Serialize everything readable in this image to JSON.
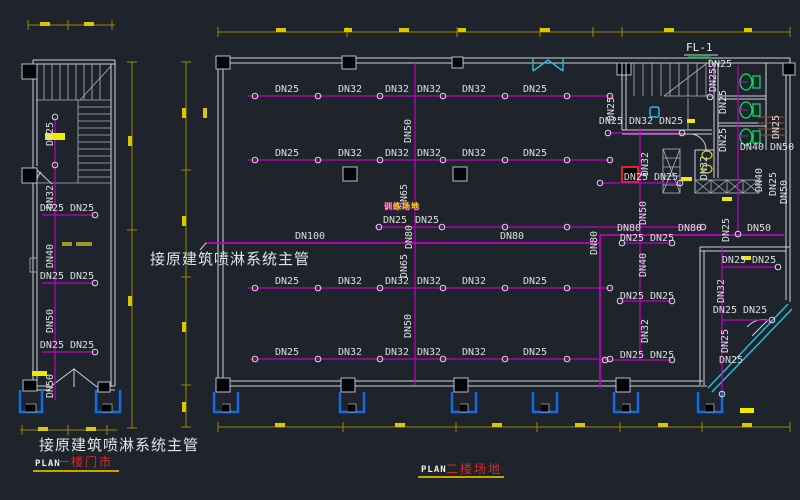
{
  "colors": {
    "background": "#1f242c",
    "pipe": "#c000c0",
    "wall": "#cdd2d8",
    "dim": "#9c8500",
    "dim_bright": "#d8c800",
    "highlight": "#f0ea00",
    "cyan": "#1ac8dc",
    "green": "#00a832",
    "toilet": "#1fd97e",
    "blue": "#0d6fe8",
    "red": "#d92626",
    "label": "#dcdee0",
    "title": "#e2e4e6",
    "plan_name": "#cf2b2b",
    "underline": "#c8a400",
    "area_text": "#e8e400"
  },
  "notes": {
    "main_pipe_note_mid": "接原建筑喷淋系统主管",
    "main_pipe_note_bottom": "接原建筑喷淋系统主管"
  },
  "plans": {
    "plan1": {
      "label": "PLAN",
      "name": "一楼门市"
    },
    "plan2": {
      "label": "PLAN",
      "name": "二楼场地"
    }
  },
  "annotations": {
    "floor_drain": "FL-1",
    "area": "训练场地"
  },
  "pipe_labels": [
    {
      "t": "DN25",
      "x": 51,
      "y": 134,
      "r": 1
    },
    {
      "t": "DN32",
      "x": 51,
      "y": 197,
      "r": 1
    },
    {
      "t": "DN40",
      "x": 51,
      "y": 256,
      "r": 1
    },
    {
      "t": "DN50",
      "x": 51,
      "y": 321,
      "r": 1
    },
    {
      "t": "DN50",
      "x": 51,
      "y": 386,
      "r": 1
    },
    {
      "t": "DN25 DN25",
      "x": 67,
      "y": 209
    },
    {
      "t": "DN25 DN25",
      "x": 67,
      "y": 277
    },
    {
      "t": "DN25 DN25",
      "x": 67,
      "y": 346
    },
    {
      "t": "DN25",
      "x": 287,
      "y": 90
    },
    {
      "t": "DN32",
      "x": 350,
      "y": 90
    },
    {
      "t": "DN32",
      "x": 397,
      "y": 90
    },
    {
      "t": "DN32",
      "x": 429,
      "y": 90
    },
    {
      "t": "DN32",
      "x": 474,
      "y": 90
    },
    {
      "t": "DN25",
      "x": 535,
      "y": 90
    },
    {
      "t": "DN25",
      "x": 287,
      "y": 154
    },
    {
      "t": "DN32",
      "x": 350,
      "y": 154
    },
    {
      "t": "DN32",
      "x": 397,
      "y": 154
    },
    {
      "t": "DN32",
      "x": 429,
      "y": 154
    },
    {
      "t": "DN32",
      "x": 474,
      "y": 154
    },
    {
      "t": "DN25",
      "x": 535,
      "y": 154
    },
    {
      "t": "DN25",
      "x": 395,
      "y": 221
    },
    {
      "t": "DN25",
      "x": 427,
      "y": 221
    },
    {
      "t": "DN25",
      "x": 287,
      "y": 282
    },
    {
      "t": "DN32",
      "x": 350,
      "y": 282
    },
    {
      "t": "DN32",
      "x": 397,
      "y": 282
    },
    {
      "t": "DN32",
      "x": 429,
      "y": 282
    },
    {
      "t": "DN32",
      "x": 474,
      "y": 282
    },
    {
      "t": "DN25",
      "x": 535,
      "y": 282
    },
    {
      "t": "DN25",
      "x": 287,
      "y": 353
    },
    {
      "t": "DN32",
      "x": 350,
      "y": 353
    },
    {
      "t": "DN32",
      "x": 397,
      "y": 353
    },
    {
      "t": "DN32",
      "x": 429,
      "y": 353
    },
    {
      "t": "DN32",
      "x": 474,
      "y": 353
    },
    {
      "t": "DN25",
      "x": 535,
      "y": 353
    },
    {
      "t": "DN50",
      "x": 409,
      "y": 131,
      "r": 1
    },
    {
      "t": "DN65",
      "x": 405,
      "y": 196,
      "r": 1
    },
    {
      "t": "DN80",
      "x": 410,
      "y": 237,
      "r": 1
    },
    {
      "t": "DN65",
      "x": 405,
      "y": 266,
      "r": 1
    },
    {
      "t": "DN50",
      "x": 409,
      "y": 326,
      "r": 1
    },
    {
      "t": "DN100",
      "x": 310,
      "y": 237
    },
    {
      "t": "DN80",
      "x": 512,
      "y": 237
    },
    {
      "t": "DN80",
      "x": 629,
      "y": 229
    },
    {
      "t": "DN80",
      "x": 690,
      "y": 229
    },
    {
      "t": "DN50",
      "x": 759,
      "y": 229
    },
    {
      "t": "DN80",
      "x": 595,
      "y": 243,
      "r": 1
    },
    {
      "t": "DN25",
      "x": 612,
      "y": 109,
      "r": 1
    },
    {
      "t": "DN25 DN32 DN25",
      "x": 641,
      "y": 122
    },
    {
      "t": "DN32",
      "x": 646,
      "y": 164,
      "r": 1
    },
    {
      "t": "DN25 DN25",
      "x": 651,
      "y": 178
    },
    {
      "t": "DN50",
      "x": 644,
      "y": 213,
      "r": 1
    },
    {
      "t": "DN25 DN25",
      "x": 647,
      "y": 239
    },
    {
      "t": "DN40",
      "x": 644,
      "y": 265,
      "r": 1
    },
    {
      "t": "DN25 DN25",
      "x": 647,
      "y": 297
    },
    {
      "t": "DN32",
      "x": 646,
      "y": 331,
      "r": 1
    },
    {
      "t": "DN25 DN25",
      "x": 647,
      "y": 356
    },
    {
      "t": "DN25",
      "x": 720,
      "y": 65
    },
    {
      "t": "DN25",
      "x": 714,
      "y": 80,
      "r": 1
    },
    {
      "t": "DN25",
      "x": 724,
      "y": 102,
      "r": 1
    },
    {
      "t": "DN25",
      "x": 724,
      "y": 140,
      "r": 1
    },
    {
      "t": "DN25",
      "x": 777,
      "y": 127,
      "r": 1
    },
    {
      "t": "DN40 DN50",
      "x": 767,
      "y": 148
    },
    {
      "t": "DN40",
      "x": 760,
      "y": 180,
      "r": 1
    },
    {
      "t": "DN25",
      "x": 774,
      "y": 184,
      "r": 1
    },
    {
      "t": "DN50",
      "x": 785,
      "y": 192,
      "r": 1
    },
    {
      "t": "DN32",
      "x": 705,
      "y": 168,
      "r": 1
    },
    {
      "t": "DN25",
      "x": 727,
      "y": 230,
      "r": 1
    },
    {
      "t": "DN25 DN25",
      "x": 749,
      "y": 261
    },
    {
      "t": "DN32",
      "x": 722,
      "y": 291,
      "r": 1
    },
    {
      "t": "DN25 DN25",
      "x": 740,
      "y": 311
    },
    {
      "t": "DN25",
      "x": 726,
      "y": 341,
      "r": 1
    },
    {
      "t": "DN25",
      "x": 731,
      "y": 361
    }
  ],
  "sprinklers": [
    [
      255,
      96
    ],
    [
      318,
      96
    ],
    [
      380,
      96
    ],
    [
      443,
      96
    ],
    [
      505,
      96
    ],
    [
      567,
      96
    ],
    [
      610,
      96
    ],
    [
      255,
      160
    ],
    [
      318,
      160
    ],
    [
      380,
      160
    ],
    [
      443,
      160
    ],
    [
      505,
      160
    ],
    [
      567,
      160
    ],
    [
      610,
      160
    ],
    [
      379,
      227
    ],
    [
      442,
      227
    ],
    [
      505,
      227
    ],
    [
      567,
      227
    ],
    [
      703,
      227
    ],
    [
      255,
      288
    ],
    [
      318,
      288
    ],
    [
      380,
      288
    ],
    [
      443,
      288
    ],
    [
      505,
      288
    ],
    [
      567,
      288
    ],
    [
      610,
      288
    ],
    [
      255,
      359
    ],
    [
      318,
      359
    ],
    [
      380,
      359
    ],
    [
      443,
      359
    ],
    [
      505,
      359
    ],
    [
      567,
      359
    ],
    [
      610,
      359
    ],
    [
      55,
      117
    ],
    [
      55,
      165
    ],
    [
      95,
      215
    ],
    [
      95,
      283
    ],
    [
      95,
      352
    ],
    [
      608,
      133
    ],
    [
      682,
      133
    ],
    [
      600,
      183
    ],
    [
      680,
      183
    ],
    [
      622,
      243
    ],
    [
      672,
      243
    ],
    [
      620,
      301
    ],
    [
      672,
      301
    ],
    [
      605,
      360
    ],
    [
      672,
      360
    ],
    [
      778,
      267
    ],
    [
      772,
      320
    ],
    [
      722,
      394
    ],
    [
      738,
      234
    ],
    [
      710,
      97
    ]
  ]
}
